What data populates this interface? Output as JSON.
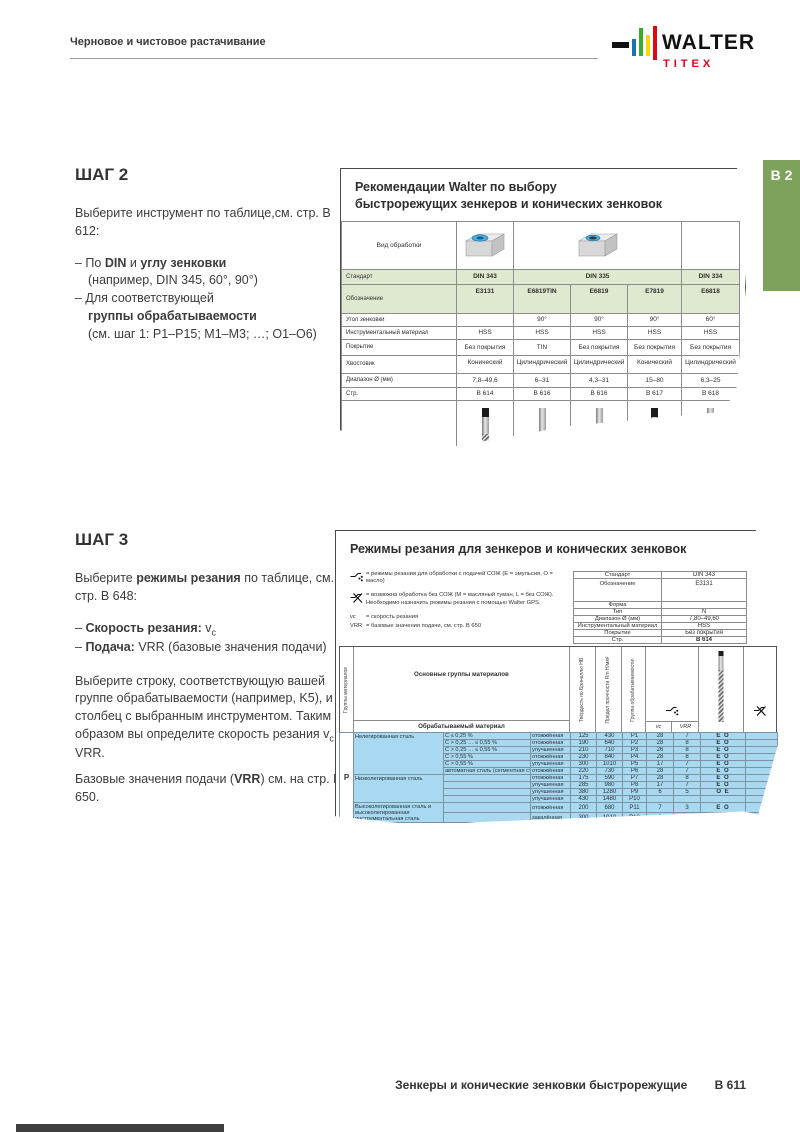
{
  "header": {
    "left": "Черновое и чистовое растачивание",
    "brand": {
      "word": "WALTER",
      "sub": "TITEX"
    },
    "tab": "B 2"
  },
  "colors": {
    "accent_green": "#7ca25c",
    "table_header_green": "#dfe9d0",
    "row_blue": "#a9d9f1",
    "brand_red": "#e2001a",
    "logo_bars": [
      "#1d71b8",
      "#3aaa35",
      "#ffd500",
      "#e30613"
    ]
  },
  "step2": {
    "title": "ШАГ 2",
    "intro_l1": "Выберите инструмент по таблице,",
    "intro_l2": "см. стр. B 612:",
    "b1_pre": "– По ",
    "b1_bold1": "DIN",
    "b1_mid": " и ",
    "b1_bold2": "углу зенковки",
    "b1_sub": "(например, DIN 345, 60°, 90°)",
    "b2_pre": "– Для соответствующей",
    "b2_bold": "группы обрабатываемости",
    "b2_sub": "(см. шаг 1: P1–P15; M1–M3; …; O1–O6)"
  },
  "step3": {
    "title": "ШАГ 3",
    "intro_pre": "Выберите ",
    "intro_bold": "режимы резания",
    "intro_post": " по таблице,",
    "intro_l2": "см. стр. B 648:",
    "b1_bold": "Скорость резания: ",
    "b1_val": "v",
    "b1_valsub": "c",
    "b2_bold": "Подача: ",
    "b2_rest": "VRR (базовые значения подачи)",
    "p1_pre": "Выберите строку, соответствующую вашей группе обрабатываемости (например, K5), и столбец с выбранным инструментом. Таким образом вы определите скорость резания v",
    "p1_sub": "c",
    "p1_post": " и VRR.",
    "p2_pre": "Базовые значения подачи (",
    "p2_bold": "VRR",
    "p2_post": ") см. на стр. B 650."
  },
  "table1": {
    "title_l1": "Рекомендации Walter по выбору",
    "title_l2": "быстрорежущих зенкеров и конических зенковок",
    "machining_label": "Вид обработки",
    "icons": [
      "countersink-3d-icon",
      "counterbore-3d-icon"
    ],
    "rows": [
      {
        "label": "Стандарт",
        "values": [
          "DIN 343",
          "DIN 335",
          "DIN 334"
        ]
      },
      {
        "label": "Обозначение",
        "values": [
          "E3131",
          "E6819TIN",
          "E6819",
          "E7819",
          "E6818"
        ]
      },
      {
        "label": "Угол зенковки",
        "values": [
          "",
          "90°",
          "90°",
          "90°",
          "60°"
        ]
      },
      {
        "label": "Инструментальный материал",
        "values": [
          "HSS",
          "HSS",
          "HSS",
          "HSS",
          "HSS"
        ]
      },
      {
        "label": "Покрытие",
        "values": [
          "Без покрытия",
          "TIN",
          "Без покрытия",
          "Без покрытия",
          "Без покрытия"
        ]
      },
      {
        "label": "Хвостовик",
        "values": [
          "Конический",
          "Цилиндрический",
          "Цилиндрический",
          "Конический",
          "Цилиндрический"
        ]
      },
      {
        "label": "Диапазон Ø (мм)",
        "values": [
          "7,8–49,6",
          "6–31",
          "4,3–31",
          "15–80",
          "6,3–25"
        ]
      },
      {
        "label": "Стр.",
        "values": [
          "B 614",
          "B 616",
          "B 616",
          "B 617",
          "B 618"
        ]
      }
    ]
  },
  "table2": {
    "title": "Режимы резания для зенкеров и конических зенковок",
    "legend": {
      "coolant": "= режимы резания для обработки с подачей СОЖ (E = эмульсия, O = масло)",
      "dry1": "= возможна обработка без СОЖ (M = масляный туман, L = без СОЖ).",
      "dry2": "Необходимо назначить режимы резания с помощью Walter GPS.",
      "vc_sym": "vc",
      "vc_def": "= скорость резания",
      "vrr_sym": "VRR",
      "vrr_def": "= базовые значения подачи, см. стр. B 650"
    },
    "info_rows": [
      {
        "label": "Стандарт",
        "value": "DIN 343"
      },
      {
        "label": "Обозначение",
        "value": "E3131"
      },
      {
        "label": "Форма",
        "value": ""
      },
      {
        "label": "Тип",
        "value": "N"
      },
      {
        "label": "Диапазон Ø (мм)",
        "value": "7,80–49,60"
      },
      {
        "label": "Инструментальный материал",
        "value": "HSS"
      },
      {
        "label": "Покрытие",
        "value": "Без покрытия"
      },
      {
        "label": "Стр.",
        "value": "B 614"
      }
    ],
    "matrix": {
      "group_axis": "Группы материалов",
      "main_header": "Основные группы материалов",
      "material_header": "Обрабатываемый материал",
      "col_headers": [
        "Твёрдость по Бринеллю HB",
        "Предел прочности Rm Н/мм²",
        "Группа обрабатываемости¹"
      ],
      "sub_headers": [
        "vc",
        "VRR"
      ],
      "group_letter": "P",
      "rows": [
        {
          "group": "Нелегированная сталь",
          "spec": "C ≤ 0,25 %",
          "state": "отожжённая",
          "hb": "125",
          "rm": "430",
          "mg": "P1",
          "vc": "28",
          "vrr": "7",
          "cool": "E O"
        },
        {
          "spec": "C > 0,25 … ≤ 0,55 %",
          "state": "отожжённая",
          "hb": "190",
          "rm": "640",
          "mg": "P2",
          "vc": "28",
          "vrr": "8",
          "cool": "E O"
        },
        {
          "spec": "C > 0,25 … ≤ 0,55 %",
          "state": "улучшенная",
          "hb": "210",
          "rm": "710",
          "mg": "P3",
          "vc": "26",
          "vrr": "8",
          "cool": "E O"
        },
        {
          "spec": "C > 0,55 %",
          "state": "отожжённая",
          "hb": "230",
          "rm": "840",
          "mg": "P4",
          "vc": "28",
          "vrr": "8",
          "cool": "E O"
        },
        {
          "spec": "C > 0,55 %",
          "state": "улучшенная",
          "hb": "300",
          "rm": "1010",
          "mg": "P5",
          "vc": "17",
          "vrr": "7",
          "cool": "E O"
        },
        {
          "spec": "автоматная сталь (сегментная стружка)",
          "state": "отожжённая",
          "hb": "220",
          "rm": "730",
          "mg": "P6",
          "vc": "28",
          "vrr": "7",
          "cool": "E O"
        },
        {
          "group": "Низколегированная сталь",
          "spec": "",
          "state": "отожжённая",
          "hb": "175",
          "rm": "590",
          "mg": "P7",
          "vc": "28",
          "vrr": "8",
          "cool": "E O"
        },
        {
          "spec": "",
          "state": "улучшенная",
          "hb": "285",
          "rm": "980",
          "mg": "P8",
          "vc": "17",
          "vrr": "7",
          "cool": "E O"
        },
        {
          "spec": "",
          "state": "улучшенная",
          "hb": "380",
          "rm": "1280",
          "mg": "P9",
          "vc": "6",
          "vrr": "5",
          "cool": "O E"
        },
        {
          "spec": "",
          "state": "улучшенная",
          "hb": "430",
          "rm": "1480",
          "mg": "P10",
          "vc": "",
          "vrr": "",
          "cool": ""
        },
        {
          "group": "Высоколегированная сталь и высоколегированная инструментальная сталь",
          "spec": "",
          "state": "отожжённая",
          "hb": "200",
          "rm": "680",
          "mg": "P11",
          "vc": "7",
          "vrr": "3",
          "cool": "E O"
        },
        {
          "spec": "",
          "state": "закалённая",
          "hb": "300",
          "rm": "1010",
          "mg": "P12",
          "vc": "6",
          "vrr": "4",
          "cool": "E O"
        }
      ]
    }
  },
  "footer": {
    "title": "Зенкеры и конические зенковки быстрорежущие",
    "page": "B 611"
  }
}
